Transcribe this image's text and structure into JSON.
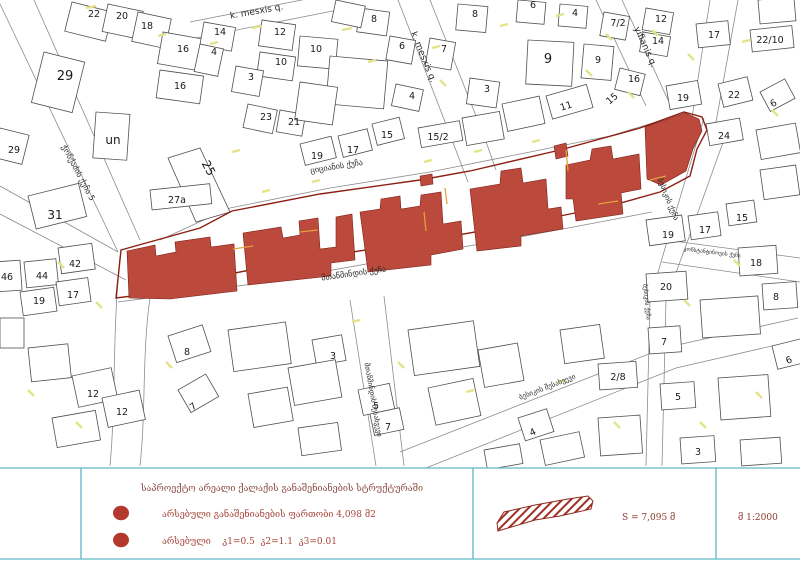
{
  "map": {
    "colors": {
      "project_red": "#bc4a3c",
      "boundary_red": "#8e1f14",
      "legend_accent": "#5fb6c9",
      "legend_text": "#96433a",
      "highlight_yellow": "#e3e388",
      "accent_orange": "#e2a23e"
    },
    "street_labels": [
      {
        "text": "k. mesxis q.",
        "x": 257,
        "y": 14,
        "rot": -10,
        "size": 9
      },
      {
        "text": "k. mesxis q.",
        "x": 421,
        "y": 58,
        "rot": 68,
        "size": 9
      },
      {
        "text": "yifianis q.",
        "x": 643,
        "y": 48,
        "rot": 66,
        "size": 9
      },
      {
        "text": "ჭონქაძის ქუჩა 5",
        "x": 76,
        "y": 174,
        "rot": 62,
        "size": 8
      },
      {
        "text": "ციციანის ქუჩა",
        "x": 337,
        "y": 169,
        "rot": -9,
        "size": 8
      },
      {
        "text": "მთაწმინდის ქუჩა",
        "x": 354,
        "y": 276,
        "rot": -8,
        "size": 8
      },
      {
        "text": "ბესიკის ქუჩა",
        "x": 666,
        "y": 200,
        "rot": 68,
        "size": 7.5
      },
      {
        "text": "კონსტანტინოვის ქუჩა",
        "x": 712,
        "y": 254,
        "rot": 7,
        "size": 5.5
      },
      {
        "text": "მთაწმინდის შესახვევი",
        "x": 371,
        "y": 400,
        "rot": 80,
        "size": 7
      },
      {
        "text": "ბესიკის შესახვევი",
        "x": 548,
        "y": 389,
        "rot": -21,
        "size": 7
      },
      {
        "text": "ბესიკის ქუჩა",
        "x": 645,
        "y": 302,
        "rot": 84,
        "size": 6
      }
    ],
    "plot_numbers": [
      {
        "text": "22",
        "x": 94,
        "y": 17
      },
      {
        "text": "20",
        "x": 122,
        "y": 19
      },
      {
        "text": "18",
        "x": 147,
        "y": 29
      },
      {
        "text": "16",
        "x": 183,
        "y": 52
      },
      {
        "text": "16",
        "x": 180,
        "y": 89
      },
      {
        "text": "29",
        "x": 65,
        "y": 80,
        "size": 13
      },
      {
        "text": "29",
        "x": 14,
        "y": 153
      },
      {
        "text": "un",
        "x": 113,
        "y": 144,
        "size": 12
      },
      {
        "text": "25",
        "x": 205,
        "y": 170,
        "rot": 62,
        "size": 12
      },
      {
        "text": "27a",
        "x": 177,
        "y": 203
      },
      {
        "text": "31",
        "x": 55,
        "y": 219,
        "size": 12
      },
      {
        "text": "42",
        "x": 75,
        "y": 267
      },
      {
        "text": "44",
        "x": 42,
        "y": 279
      },
      {
        "text": "46",
        "x": 7,
        "y": 280
      },
      {
        "text": "17",
        "x": 73,
        "y": 298
      },
      {
        "text": "19",
        "x": 39,
        "y": 304
      },
      {
        "text": "14",
        "x": 220,
        "y": 35
      },
      {
        "text": "4",
        "x": 214,
        "y": 55
      },
      {
        "text": "12",
        "x": 280,
        "y": 35
      },
      {
        "text": "10",
        "x": 316,
        "y": 52
      },
      {
        "text": "10",
        "x": 281,
        "y": 65
      },
      {
        "text": "3",
        "x": 251,
        "y": 80
      },
      {
        "text": "8",
        "x": 374,
        "y": 22
      },
      {
        "text": "6",
        "x": 402,
        "y": 49
      },
      {
        "text": "4",
        "x": 412,
        "y": 99
      },
      {
        "text": "23",
        "x": 266,
        "y": 120
      },
      {
        "text": "21",
        "x": 294,
        "y": 125
      },
      {
        "text": "19",
        "x": 317,
        "y": 159
      },
      {
        "text": "17",
        "x": 353,
        "y": 153
      },
      {
        "text": "15",
        "x": 387,
        "y": 138
      },
      {
        "text": "15/2",
        "x": 438,
        "y": 140
      },
      {
        "text": "8",
        "x": 475,
        "y": 17
      },
      {
        "text": "6",
        "x": 533,
        "y": 8
      },
      {
        "text": "4",
        "x": 575,
        "y": 16
      },
      {
        "text": "7",
        "x": 444,
        "y": 52
      },
      {
        "text": "7/2",
        "x": 618,
        "y": 26
      },
      {
        "text": "9",
        "x": 548,
        "y": 63,
        "size": 13
      },
      {
        "text": "9",
        "x": 598,
        "y": 63
      },
      {
        "text": "3",
        "x": 487,
        "y": 92
      },
      {
        "text": "11",
        "x": 567,
        "y": 109,
        "rot": -18
      },
      {
        "text": "12",
        "x": 661,
        "y": 22
      },
      {
        "text": "14",
        "x": 658,
        "y": 44
      },
      {
        "text": "17",
        "x": 714,
        "y": 38
      },
      {
        "text": "22/10",
        "x": 770,
        "y": 43
      },
      {
        "text": "16",
        "x": 634,
        "y": 82
      },
      {
        "text": "19",
        "x": 683,
        "y": 101
      },
      {
        "text": "22",
        "x": 734,
        "y": 98
      },
      {
        "text": "6",
        "x": 775,
        "y": 106,
        "rot": -30
      },
      {
        "text": "24",
        "x": 724,
        "y": 139
      },
      {
        "text": "15",
        "x": 614,
        "y": 101,
        "rot": -40
      },
      {
        "text": "19",
        "x": 668,
        "y": 238
      },
      {
        "text": "17",
        "x": 705,
        "y": 233
      },
      {
        "text": "15",
        "x": 742,
        "y": 221
      },
      {
        "text": "18",
        "x": 756,
        "y": 266
      },
      {
        "text": "20",
        "x": 666,
        "y": 290
      },
      {
        "text": "8",
        "x": 776,
        "y": 300
      },
      {
        "text": "7",
        "x": 664,
        "y": 345
      },
      {
        "text": "2/8",
        "x": 618,
        "y": 380
      },
      {
        "text": "6",
        "x": 790,
        "y": 363,
        "rot": -20
      },
      {
        "text": "5",
        "x": 678,
        "y": 400
      },
      {
        "text": "3",
        "x": 698,
        "y": 455
      },
      {
        "text": "3",
        "x": 333,
        "y": 359
      },
      {
        "text": "5",
        "x": 376,
        "y": 409
      },
      {
        "text": "7",
        "x": 388,
        "y": 430
      },
      {
        "text": "4",
        "x": 534,
        "y": 435,
        "rot": -25
      },
      {
        "text": "12",
        "x": 93,
        "y": 397
      },
      {
        "text": "12",
        "x": 122,
        "y": 415
      },
      {
        "text": "8",
        "x": 187,
        "y": 355
      },
      {
        "text": "7",
        "x": 195,
        "y": 409,
        "rot": -38
      }
    ]
  },
  "legend": {
    "title": "საპროექტო არეალი ქალაქის განაშენიანების სტრუქტურაში",
    "rows": [
      {
        "symbol": "red-dot",
        "label": "არსებული განაშენიანების ფართობი 4,098 მ2"
      },
      {
        "symbol": "red-dot",
        "label": "არსებული    კ1=0.5  კ2=1.1  კ3=0.01"
      }
    ],
    "area_label": "S = 7,095 მ",
    "scale_label": "მ 1:2000"
  }
}
